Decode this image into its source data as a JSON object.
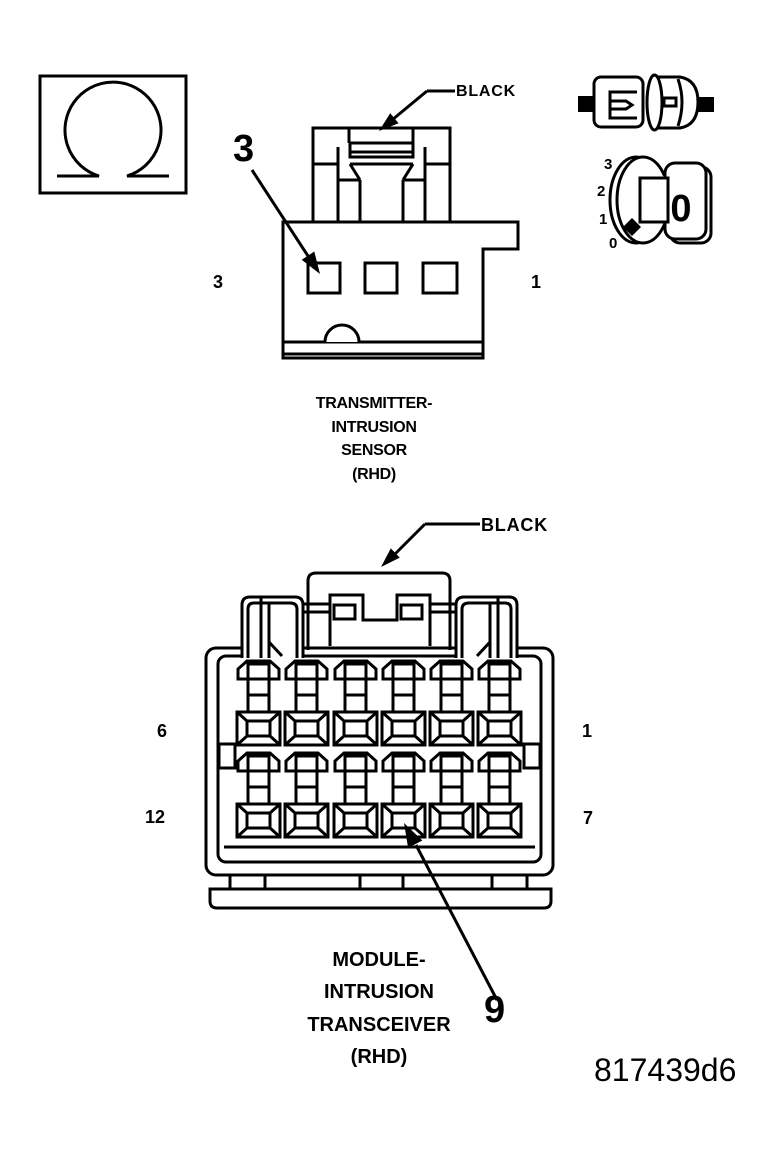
{
  "colors": {
    "ink": "#000000",
    "paper": "#ffffff"
  },
  "figure_id": "817439d6",
  "ohmmeter_icon": {
    "symbol": "omega"
  },
  "top_diagram": {
    "wire_color_label": "BLACK",
    "pin_callout": "3",
    "pin_label_left": "3",
    "pin_label_right": "1",
    "caption_lines": [
      "TRANSMITTER-",
      "INTRUSION",
      "SENSOR",
      "(RHD)"
    ]
  },
  "ignition_switch_icon": {
    "positions": [
      "3",
      "2",
      "1",
      "0"
    ],
    "key_label": "0"
  },
  "bottom_diagram": {
    "wire_color_label": "BLACK",
    "pin_callout": "9",
    "pin_label_top_left": "6",
    "pin_label_top_right": "1",
    "pin_label_bottom_left": "12",
    "pin_label_bottom_right": "7",
    "caption_lines": [
      "MODULE-",
      "INTRUSION",
      "TRANSCEIVER",
      "(RHD)"
    ]
  }
}
